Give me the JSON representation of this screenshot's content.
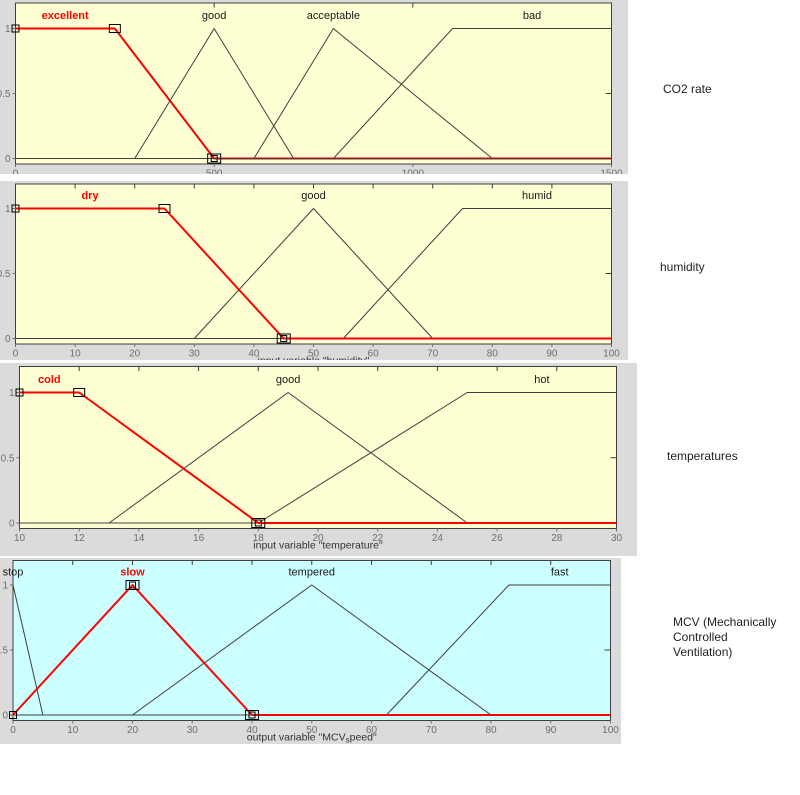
{
  "page": {
    "background": "#FFFFFF"
  },
  "colors": {
    "panel_gray": "#DBDBDB",
    "input_plot_bg": "#FFFFD4",
    "output_plot_bg": "#CCFFFF",
    "axis_stroke": "#3F3F3F",
    "curve_stroke": "#3F3F3F",
    "selected_curve": "#FF0000",
    "tick_text": "#6E6E6E",
    "mf_label_text": "#1A1A1A",
    "xlabel_text": "#333333",
    "handle_stroke": "#000000"
  },
  "captions": [
    {
      "text": "CO2 rate"
    },
    {
      "text": "humidity"
    },
    {
      "text": "temperatures"
    },
    {
      "text": "MCV (Mechanically Controlled Ventilation)"
    }
  ],
  "chart_data": [
    {
      "id": "co2-rate",
      "type": "line",
      "bg": "#FFFFD4",
      "xlim": [
        0,
        1500
      ],
      "xticks": [
        0,
        500,
        1000,
        1500
      ],
      "ylim": [
        -0.04,
        1.2
      ],
      "yticks": [
        0,
        0.5,
        1
      ],
      "xlabel": "",
      "selected_mf": "excellent",
      "selected_under": true,
      "series": [
        {
          "name": "excellent",
          "selected": true,
          "label_x": 125,
          "points": [
            [
              0,
              1
            ],
            [
              250,
              1
            ],
            [
              500,
              0
            ],
            [
              1500,
              0
            ]
          ],
          "handles_small": [
            [
              0,
              1
            ]
          ],
          "handles_mid": [
            [
              250,
              1
            ]
          ],
          "handles_active": [
            [
              500,
              0
            ]
          ]
        },
        {
          "name": "good",
          "label_x": 500,
          "points": [
            [
              300,
              0
            ],
            [
              500,
              1
            ],
            [
              700,
              0
            ]
          ]
        },
        {
          "name": "acceptable",
          "label_x": 800,
          "points": [
            [
              600,
              0
            ],
            [
              800,
              1
            ],
            [
              1200,
              0
            ]
          ]
        },
        {
          "name": "bad",
          "label_x": 1300,
          "points": [
            [
              800,
              0
            ],
            [
              1100,
              1
            ],
            [
              1500,
              1
            ]
          ]
        }
      ]
    },
    {
      "id": "humidity",
      "type": "line",
      "bg": "#FFFFD4",
      "xlim": [
        0,
        100
      ],
      "xticks": [
        0,
        10,
        20,
        30,
        40,
        50,
        60,
        70,
        80,
        90,
        100
      ],
      "ylim": [
        -0.04,
        1.2
      ],
      "yticks": [
        0,
        0.5,
        1
      ],
      "xlabel": "input variable \"humidity\"",
      "selected_mf": "dry",
      "selected_under": false,
      "series": [
        {
          "name": "dry",
          "selected": true,
          "label_x": 12.5,
          "points": [
            [
              0,
              1
            ],
            [
              25,
              1
            ],
            [
              45,
              0
            ],
            [
              100,
              0
            ]
          ],
          "handles_small": [
            [
              0,
              1
            ]
          ],
          "handles_mid": [
            [
              25,
              1
            ]
          ],
          "handles_active": [
            [
              45,
              0
            ]
          ]
        },
        {
          "name": "good",
          "label_x": 50,
          "points": [
            [
              30,
              0
            ],
            [
              50,
              1
            ],
            [
              70,
              0
            ]
          ]
        },
        {
          "name": "humid",
          "label_x": 87.5,
          "points": [
            [
              55,
              0
            ],
            [
              75,
              1
            ],
            [
              100,
              1
            ]
          ]
        }
      ]
    },
    {
      "id": "temperature",
      "type": "line",
      "bg": "#FFFFD4",
      "xlim": [
        10,
        30
      ],
      "xticks": [
        10,
        12,
        14,
        16,
        18,
        20,
        22,
        24,
        26,
        28,
        30
      ],
      "ylim": [
        -0.04,
        1.2
      ],
      "yticks": [
        0,
        0.5,
        1
      ],
      "xlabel": "input variable \"temperature\"",
      "selected_mf": "cold",
      "selected_under": false,
      "series": [
        {
          "name": "cold",
          "selected": true,
          "label_x": 11,
          "points": [
            [
              10,
              1
            ],
            [
              12,
              1
            ],
            [
              18,
              0
            ],
            [
              30,
              0
            ]
          ],
          "handles_small": [
            [
              10,
              1
            ]
          ],
          "handles_mid": [
            [
              12,
              1
            ]
          ],
          "handles_active": [
            [
              18,
              0
            ]
          ]
        },
        {
          "name": "good",
          "label_x": 19,
          "points": [
            [
              13,
              0
            ],
            [
              19,
              1
            ],
            [
              25,
              0
            ]
          ]
        },
        {
          "name": "hot",
          "label_x": 27.5,
          "points": [
            [
              18,
              0
            ],
            [
              25,
              1
            ],
            [
              30,
              1
            ]
          ]
        }
      ]
    },
    {
      "id": "mcv-speed",
      "type": "line",
      "bg": "#CCFFFF",
      "xlim": [
        0,
        100
      ],
      "xticks": [
        0,
        10,
        20,
        30,
        40,
        50,
        60,
        70,
        80,
        90,
        100
      ],
      "ylim": [
        -0.04,
        1.2
      ],
      "yticks": [
        0,
        0.5,
        1
      ],
      "xlabel": "output variable \"MCV_speed\"",
      "selected_mf": "slow",
      "selected_under": false,
      "series": [
        {
          "name": "stop",
          "label_x": 0,
          "points": [
            [
              0,
              1
            ],
            [
              5,
              0
            ],
            [
              100,
              0
            ]
          ]
        },
        {
          "name": "slow",
          "selected": true,
          "label_x": 20,
          "points": [
            [
              0,
              0
            ],
            [
              20,
              1
            ],
            [
              40,
              0
            ],
            [
              100,
              0
            ]
          ],
          "handles_small": [
            [
              0,
              0
            ]
          ],
          "handles_mid": [],
          "handles_active": [
            [
              20,
              1
            ],
            [
              40,
              0
            ]
          ]
        },
        {
          "name": "tempered",
          "label_x": 50,
          "points": [
            [
              20,
              0
            ],
            [
              50,
              1
            ],
            [
              80,
              0
            ]
          ]
        },
        {
          "name": "fast",
          "label_x": 91.5,
          "points": [
            [
              62.5,
              0
            ],
            [
              83,
              1
            ],
            [
              100,
              1
            ]
          ]
        }
      ]
    }
  ]
}
